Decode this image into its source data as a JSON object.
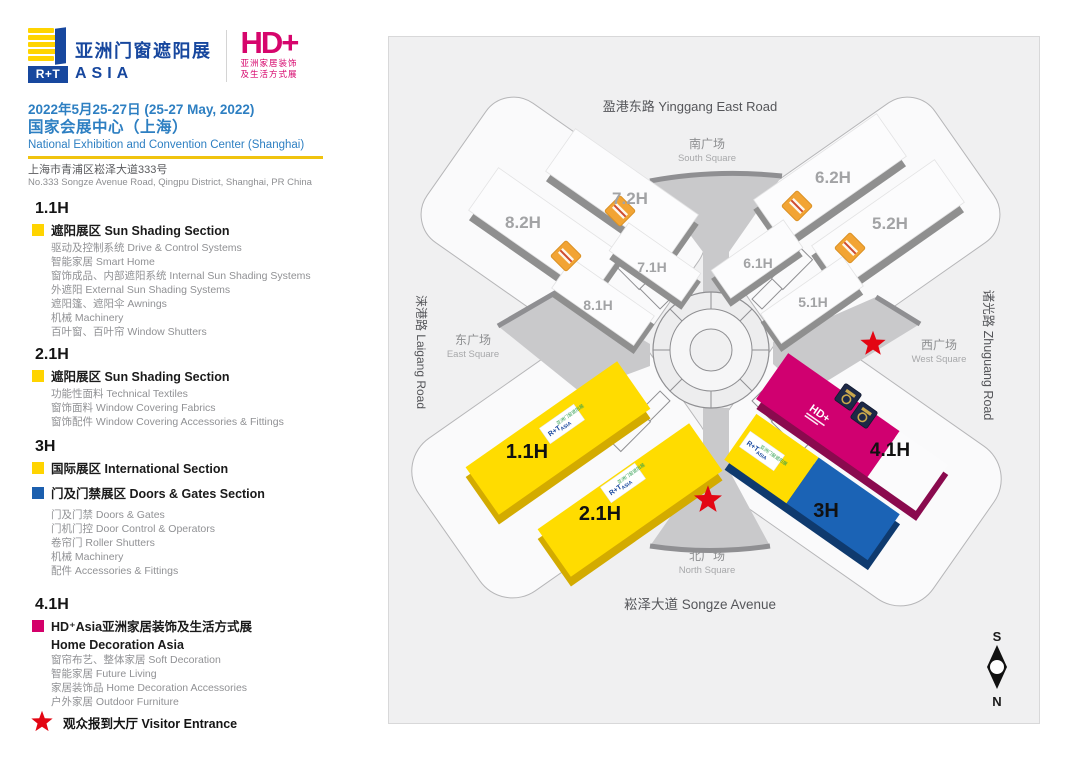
{
  "header": {
    "rt_logo": {
      "rt": "R+T",
      "name_cn": "亚洲门窗遮阳展",
      "name_en": "ASIA"
    },
    "hd_logo": {
      "mark": "HD+",
      "sub_cn1": "亚洲家居装饰",
      "sub_cn2": "及生活方式展"
    },
    "date": "2022年5月25-27日 (25-27 May, 2022)",
    "venue_cn": "国家会展中心（上海）",
    "venue_en": "National Exhibition and Convention Center (Shanghai)",
    "address_cn": "上海市青浦区崧泽大道333号",
    "address_en": "No.333 Songze Avenue Road, Qingpu District, Shanghai, PR China"
  },
  "legend": {
    "sections": [
      {
        "hall": "1.1H",
        "groups": [
          {
            "swatch": "yellow",
            "title": "遮阳展区 Sun Shading Section",
            "items": [
              "驱动及控制系统 Drive & Control Systems",
              "智能家居 Smart Home",
              "窗饰成品、内部遮阳系统 Internal Sun Shading Systems",
              "外遮阳 External Sun Shading Systems",
              "遮阳篷、遮阳伞 Awnings",
              "机械 Machinery",
              "百叶窗、百叶帘 Window Shutters"
            ]
          }
        ]
      },
      {
        "hall": "2.1H",
        "groups": [
          {
            "swatch": "yellow",
            "title": "遮阳展区 Sun Shading Section",
            "items": [
              "功能性面料 Technical Textiles",
              "窗饰面料 Window Covering Fabrics",
              "窗饰配件 Window Covering Accessories & Fittings"
            ]
          }
        ]
      },
      {
        "hall": "3H",
        "groups": [
          {
            "swatch": "yellow",
            "title": "国际展区 International Section",
            "items": []
          },
          {
            "swatch": "blue",
            "title": "门及门禁展区 Doors & Gates Section",
            "items": [
              "门及门禁 Doors & Gates",
              "门机门控 Door Control & Operators",
              "卷帘门 Roller Shutters",
              "机械 Machinery",
              "配件 Accessories & Fittings"
            ]
          }
        ]
      },
      {
        "hall": "4.1H",
        "groups": [
          {
            "swatch": "magenta",
            "title": "HD⁺Asia亚洲家居装饰及生活方式展",
            "subtitle": "Home Decoration Asia",
            "items": [
              "窗帘布艺、整体家居 Soft Decoration",
              "智能家居 Future Living",
              "家居装饰品 Home Decoration Accessories",
              "户外家居 Outdoor Furniture"
            ]
          }
        ]
      }
    ],
    "visitor_entrance": "观众报到大厅 Visitor Entrance"
  },
  "map": {
    "roads": {
      "top": "盈港东路 Yinggang East Road",
      "bottom": "崧泽大道 Songze Avenue",
      "left": "涞港路 Laigang Road",
      "right": "诸光路 Zhuguang Road"
    },
    "squares": {
      "south": {
        "cn": "南广场",
        "en": "South Square"
      },
      "north": {
        "cn": "北广场",
        "en": "North Square"
      },
      "east": {
        "cn": "东广场",
        "en": "East Square"
      },
      "west": {
        "cn": "西广场",
        "en": "West Square"
      }
    },
    "halls": {
      "h82": "8.2H",
      "h72": "7.2H",
      "h71": "7.1H",
      "h81": "8.1H",
      "h62": "6.2H",
      "h52": "5.2H",
      "h61": "6.1H",
      "h51": "5.1H",
      "h11": "1.1H",
      "h21": "2.1H",
      "h3": "3H",
      "h41": "4.1H"
    },
    "badges": {
      "rt": "R+T",
      "rt_cn": "亚洲门窗遮阳展",
      "rt_en": "ASIA",
      "hd": "HD+"
    },
    "compass": {
      "s": "S",
      "n": "N"
    }
  },
  "colors": {
    "brand_blue": "#17479e",
    "text_blue": "#2d7fc2",
    "yellow": "#ffd400",
    "section_blue": "#1c5fae",
    "magenta": "#d4006a",
    "hall_magenta": "#d00070",
    "hall_blue": "#1b63b5",
    "star_red": "#e30613",
    "map_bg": "#f0f0f1",
    "funnel_gray": "#c9c9cb",
    "escalator_orange": "#f2a434"
  }
}
